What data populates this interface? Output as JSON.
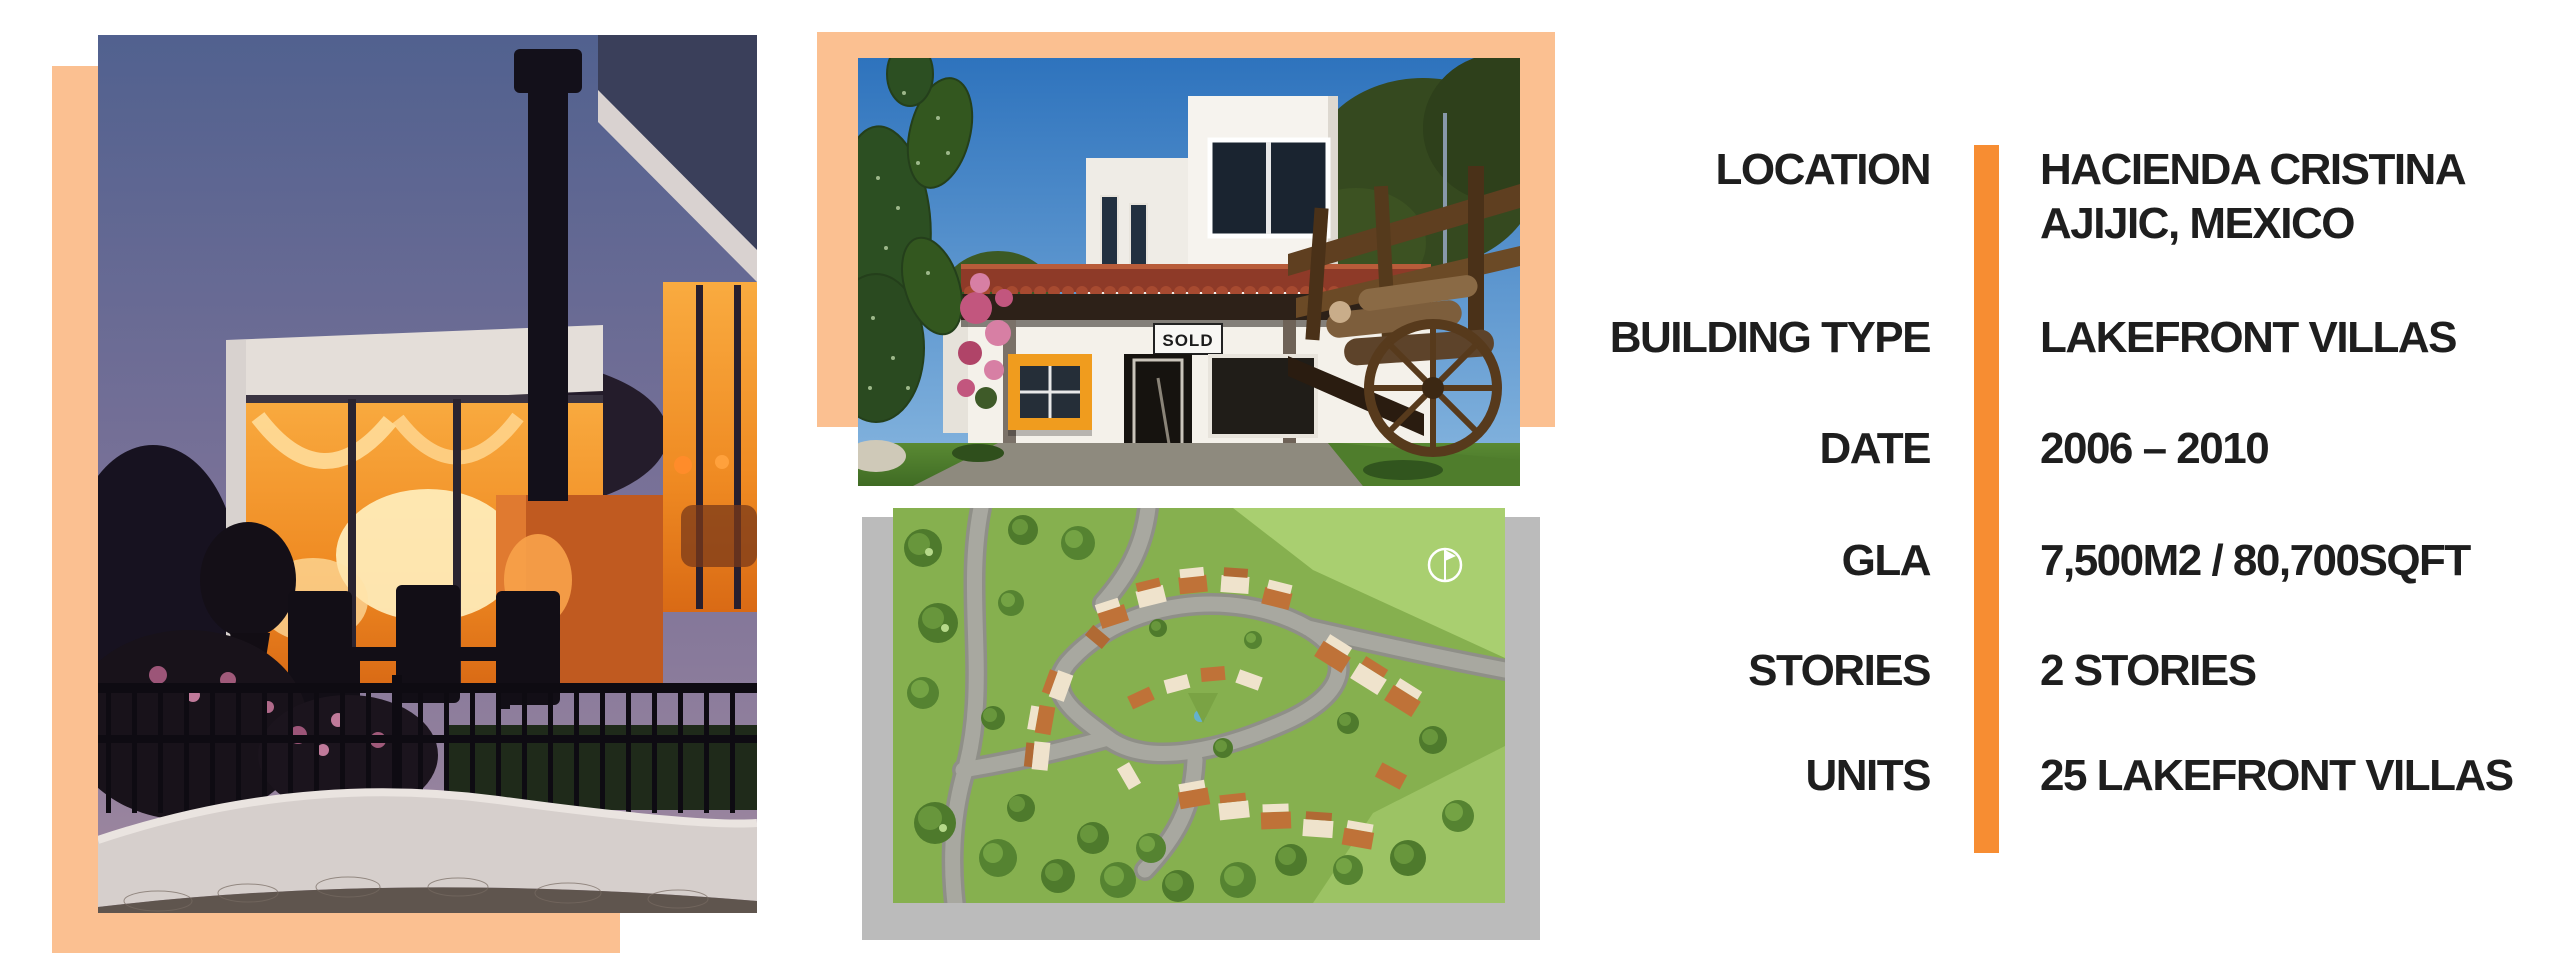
{
  "details": {
    "rows": [
      {
        "label": "LOCATION",
        "value_lines": [
          "HACIENDA CRISTINA",
          "AJIJIC, MEXICO"
        ]
      },
      {
        "label": "BUILDING TYPE",
        "value_lines": [
          "LAKEFRONT VILLAS"
        ]
      },
      {
        "label": "DATE",
        "value_lines": [
          "2006 – 2010"
        ]
      },
      {
        "label": "GLA",
        "value_lines": [
          "7,500M2 / 80,700SQFT"
        ]
      },
      {
        "label": "STORIES",
        "value_lines": [
          "2 STORIES"
        ]
      },
      {
        "label": "UNITS",
        "value_lines": [
          "25 LAKEFRONT VILLAS"
        ]
      }
    ]
  },
  "photos": {
    "middle_top": {
      "sign_text": "SOLD"
    }
  },
  "icons": {
    "compass": "north-compass-icon"
  },
  "colors": {
    "accent_orange": "#F78D32",
    "peach_backing": "#FBC091",
    "gray_backing": "#BBBBBB",
    "text": "#1E1E1E"
  }
}
